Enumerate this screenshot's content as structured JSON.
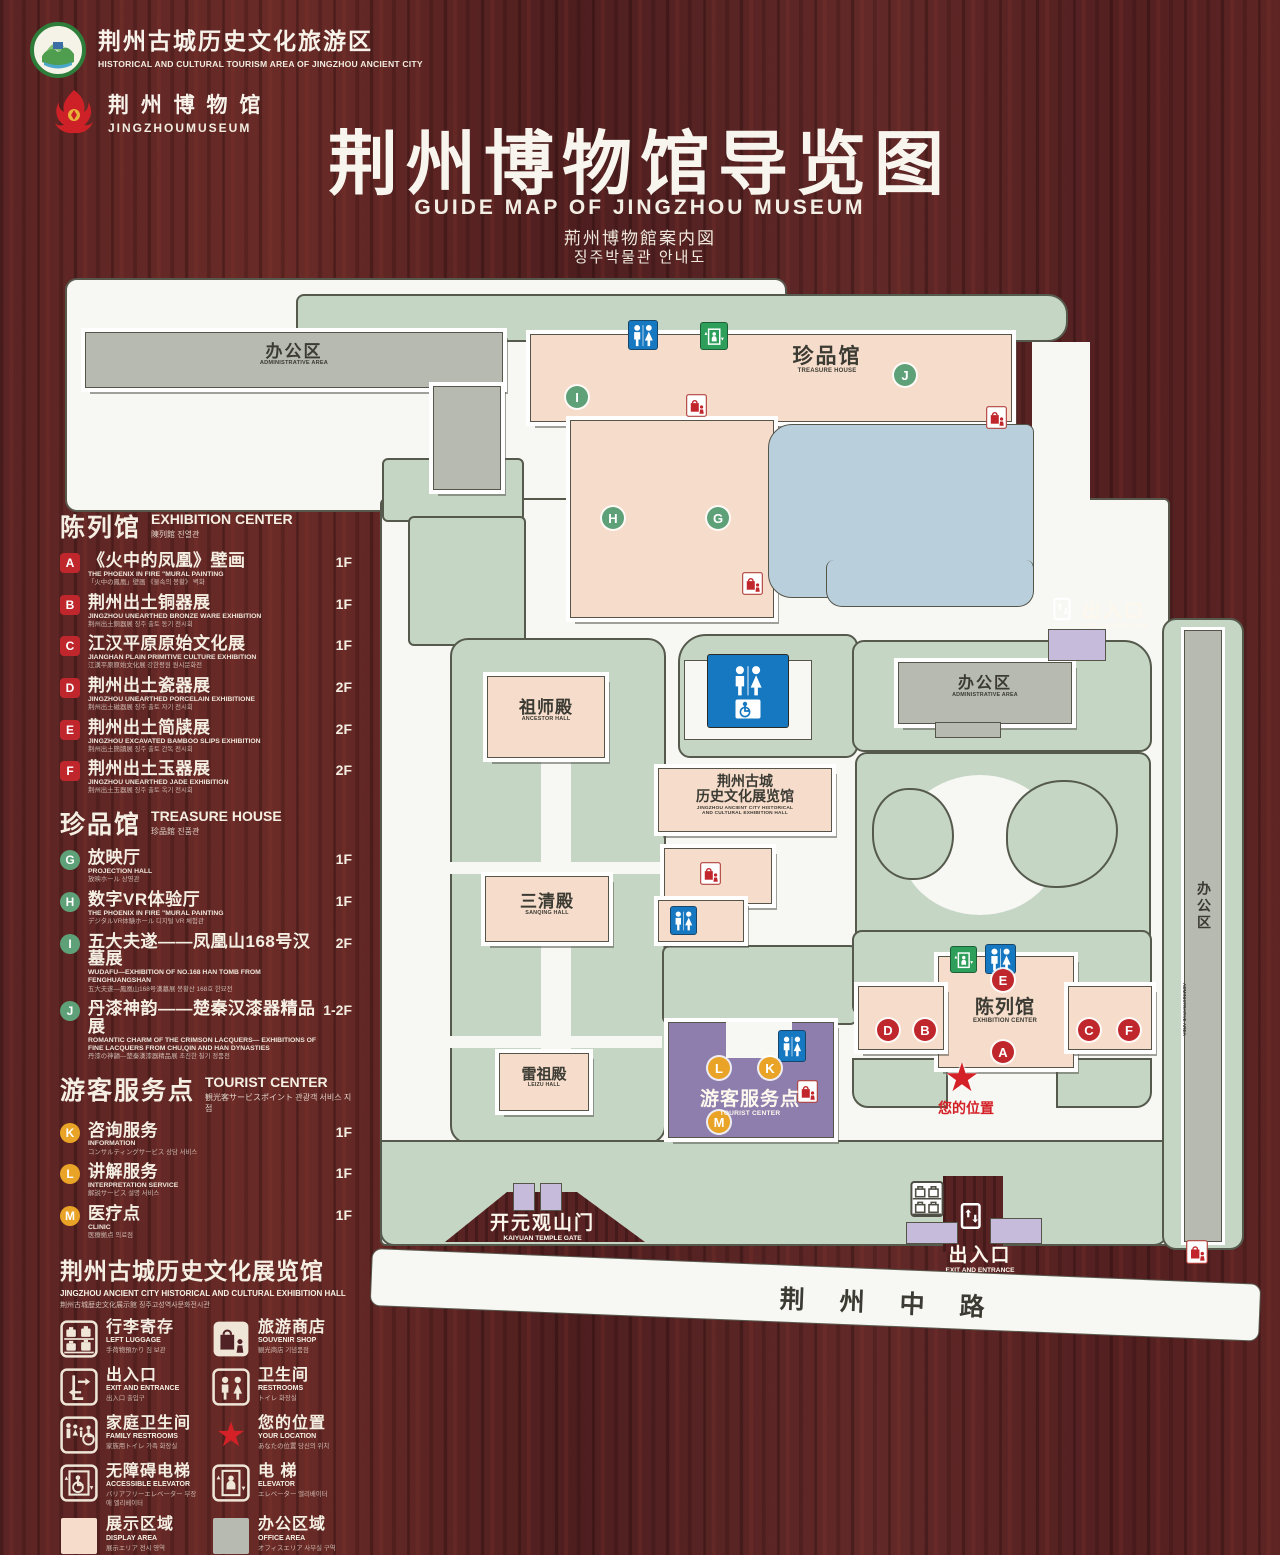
{
  "header": {
    "logo1": {
      "zh": "荆州古城历史文化旅游区",
      "en": "HISTORICAL AND CULTURAL TOURISM AREA OF JINGZHOU ANCIENT CITY"
    },
    "logo2": {
      "zh": "荆 州 博 物 馆",
      "en": "JINGZHOUMUSEUM"
    },
    "title_zh": "荆州博物馆导览图",
    "title_en": "GUIDE MAP OF JINGZHOU MUSEUM",
    "title_ja": "荊州博物館案内図",
    "title_ko": "징주박물관 안내도"
  },
  "legend": {
    "sections": [
      {
        "zh": "陈列馆",
        "en": "EXHIBITION CENTER",
        "sub": "陳列館  진열관",
        "badge_color": "#c0272d",
        "rows": [
          {
            "code": "A",
            "zh": "《火中的凤凰》壁画",
            "en": "THE PHOENIX IN FIRE \"MURAL PAINTING",
            "sub": "「火中の鳳凰」壁画 《불속의 봉황》 벽화",
            "floor": "1F"
          },
          {
            "code": "B",
            "zh": "荆州出土铜器展",
            "en": "JINGZHOU UNEARTHED BRONZE WARE EXHIBITION",
            "sub": "荆州出土銅器展  징주 출토 동기 전시회",
            "floor": "1F"
          },
          {
            "code": "C",
            "zh": "江汉平原原始文化展",
            "en": "JIANGHAN PLAIN PRIMITIVE CULTURE EXHIBITION",
            "sub": "江漢平原原始文化展  강한평원 원시문화전",
            "floor": "1F"
          },
          {
            "code": "D",
            "zh": "荆州出土瓷器展",
            "en": "JINGZHOU UNEARTHED PORCELAIN EXHIBITIONE",
            "sub": "荆州出土磁器展  징주 출토 자기 전시회",
            "floor": "2F"
          },
          {
            "code": "E",
            "zh": "荆州出土简牍展",
            "en": "JINGZHOU EXCAVATED BAMBOO SLIPS EXHIBITION",
            "sub": "荆州出土簡牘展  징주 출토 간독 전시회",
            "floor": "2F"
          },
          {
            "code": "F",
            "zh": "荆州出土玉器展",
            "en": "JINGZHOU UNEARTHED JADE EXHIBITION",
            "sub": "荆州出土玉器展  징주 출토 옥기 전시회",
            "floor": "2F"
          }
        ]
      },
      {
        "zh": "珍品馆",
        "en": "TREASURE HOUSE",
        "sub": "珍品館  진품관",
        "badge_color": "#5ea077",
        "rows": [
          {
            "code": "G",
            "zh": "放映厅",
            "en": "PROJECTION HALL",
            "sub": "放映ホール  상영관",
            "floor": "1F"
          },
          {
            "code": "H",
            "zh": "数字VR体验厅",
            "en": "THE PHOENIX IN FIRE \"MURAL PAINTING",
            "sub": "デジタルVR体験ホール  디지털 VR 체험관",
            "floor": "1F"
          },
          {
            "code": "I",
            "zh": "五大夫遂——凤凰山168号汉墓展",
            "en": "WUDAFU—EXHIBITION OF NO.168 HAN TOMB FROM FENGHUANGSHAN",
            "sub": "五大夫遂—鳳凰山168号漢墓展  봉황산 168호 한묘전",
            "floor": "2F"
          },
          {
            "code": "J",
            "zh": "丹漆神韵——楚秦汉漆器精品展",
            "en": "ROMANTIC CHARM OF THE CRIMSON LACQUERS— EXHIBITIONS OF FINE LACQUERS FROM CHU,QIN AND HAN DYNASTIES",
            "sub": "丹漆の神韻—楚秦漢漆器精品展  초진한 칠기 정품전",
            "floor": "1-2F"
          }
        ]
      },
      {
        "zh": "游客服务点",
        "en": "TOURIST CENTER",
        "sub": "観光客サービスポイント  관광객 서비스 지점",
        "badge_color": "#e9a326",
        "rows": [
          {
            "code": "K",
            "zh": "咨询服务",
            "en": "INFORMATION",
            "sub": "コンサルティングサービス  상담 서비스",
            "floor": "1F"
          },
          {
            "code": "L",
            "zh": "讲解服务",
            "en": "INTERPRETATION SERVICE",
            "sub": "解説サービス  설명 서비스",
            "floor": "1F"
          },
          {
            "code": "M",
            "zh": "医疗点",
            "en": "CLINIC",
            "sub": "医療拠点  의료점",
            "floor": "1F"
          }
        ]
      }
    ],
    "hall_title": {
      "zh": "荆州古城历史文化展览馆",
      "en": "JINGZHOU ANCIENT CITY HISTORICAL AND CULTURAL EXHIBITION HALL",
      "sub": "荆州古城歴史文化展示館    징주고성역사문화전시관"
    },
    "icons": [
      {
        "icon": "left-luggage",
        "zh": "行李寄存",
        "en": "LEFT LUGGAGE",
        "sub": "手荷物預かり  짐 보관"
      },
      {
        "icon": "souvenir-shop",
        "zh": "旅游商店",
        "en": "SOUVENIR SHOP",
        "sub": "観光商店  기념품점"
      },
      {
        "icon": "exit-entrance",
        "zh": "出入口",
        "en": "EXIT AND ENTRANCE",
        "sub": "出入口  출입구"
      },
      {
        "icon": "restrooms",
        "zh": "卫生间",
        "en": "RESTROOMS",
        "sub": "トイレ  화장실"
      },
      {
        "icon": "family-restrooms",
        "zh": "家庭卫生间",
        "en": "FAMILY RESTROOMS",
        "sub": "家族用トイレ  가족 화장실"
      },
      {
        "icon": "your-location",
        "zh": "您的位置",
        "en": "YOUR LOCATION",
        "sub": "あなたの位置  당신의 위치"
      },
      {
        "icon": "accessible-elevator",
        "zh": "无障碍电梯",
        "en": "ACCESSIBLE ELEVATOR",
        "sub": "バリアフリーエレベーター  무장애 엘리베이터"
      },
      {
        "icon": "elevator",
        "zh": "电 梯",
        "en": "ELEVATOR",
        "sub": "エレベーター  엘리베이터"
      },
      {
        "icon": "display-area",
        "zh": "展示区域",
        "en": "DISPLAY AREA",
        "sub": "展示エリア  전시 영역",
        "swatch": "#f6dccb"
      },
      {
        "icon": "office-area",
        "zh": "办公区域",
        "en": "OFFICE AREA",
        "sub": "オフィスエリア  사무실 구역",
        "swatch": "#b7bab1"
      }
    ]
  },
  "map": {
    "labels": {
      "admin_top": {
        "zh": "办公区",
        "en": "ADMINISTRATIVE AREA"
      },
      "treasure_house": {
        "zh": "珍品馆",
        "en": "TREASURE HOUSE"
      },
      "ancestor_hall": {
        "zh": "祖师殿",
        "en": "ANCESTOR HALL"
      },
      "sanqing_hall": {
        "zh": "三清殿",
        "en": "SANQING HALL"
      },
      "leizu_hall": {
        "zh": "雷祖殿",
        "en": "LEIZU HALL"
      },
      "exhibition_hall": {
        "zh1": "荆州古城",
        "zh2": "历史文化展览馆",
        "en1": "JINGZHOU ANCIENT CITY HISTORICAL",
        "en2": "AND CULTURAL EXHIBITION HALL"
      },
      "admin_mid": {
        "zh": "办公区",
        "en": "ADMINISTRATIVE AREA"
      },
      "admin_right": {
        "zh": "办公区",
        "en": "ADMINISTRATIVE AREA"
      },
      "exhibition_center": {
        "zh": "陈列馆",
        "en": "EXHIBITION CENTER"
      },
      "tourist_center": {
        "zh": "游客服务点",
        "en": "TOURIST CENTER"
      },
      "your_location": {
        "zh": "您的位置"
      },
      "gate": {
        "zh": "开元观山门",
        "en": "KAIYUAN TEMPLE GATE"
      },
      "exit_top": {
        "zh": "出入口",
        "en": "EXIT AND ENTRANCE"
      },
      "exit_bottom": {
        "zh": "出入口",
        "en": "EXIT AND ENTRANCE"
      },
      "road": {
        "zh": "荆 州 中 路"
      }
    },
    "markers": [
      {
        "letter": "I",
        "color": "green",
        "x": 577,
        "y": 397
      },
      {
        "letter": "J",
        "color": "green",
        "x": 905,
        "y": 375
      },
      {
        "letter": "H",
        "color": "green",
        "x": 613,
        "y": 518
      },
      {
        "letter": "G",
        "color": "green",
        "x": 718,
        "y": 518
      },
      {
        "letter": "E",
        "color": "red",
        "x": 1003,
        "y": 980
      },
      {
        "letter": "D",
        "color": "red",
        "x": 888,
        "y": 1030
      },
      {
        "letter": "B",
        "color": "red",
        "x": 925,
        "y": 1030
      },
      {
        "letter": "C",
        "color": "red",
        "x": 1089,
        "y": 1030
      },
      {
        "letter": "F",
        "color": "red",
        "x": 1129,
        "y": 1030
      },
      {
        "letter": "A",
        "color": "red",
        "x": 1003,
        "y": 1052
      },
      {
        "letter": "L",
        "color": "yellow",
        "x": 719,
        "y": 1068
      },
      {
        "letter": "K",
        "color": "yellow",
        "x": 770,
        "y": 1068
      },
      {
        "letter": "M",
        "color": "yellow",
        "x": 719,
        "y": 1122
      }
    ]
  }
}
